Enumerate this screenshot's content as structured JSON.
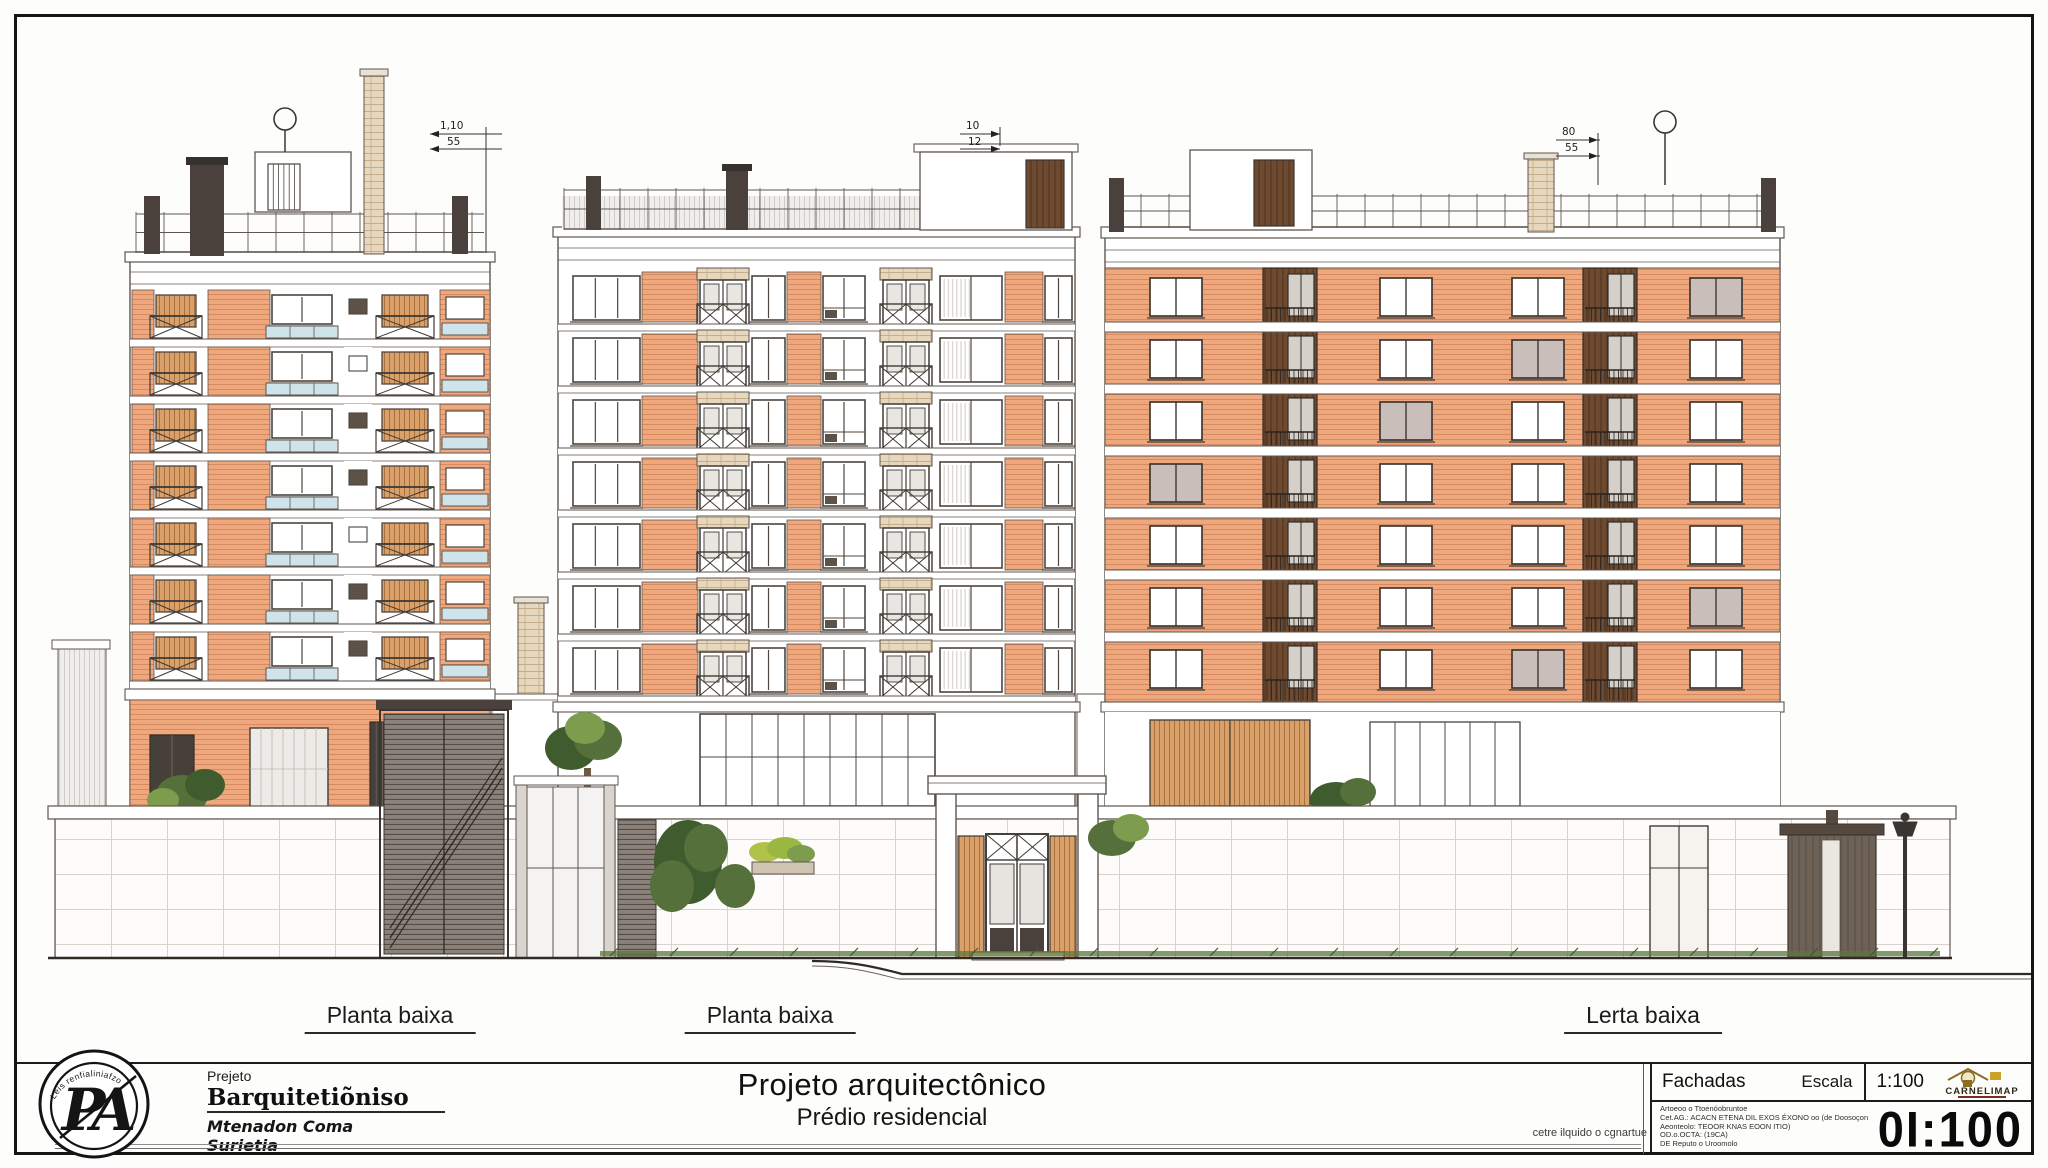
{
  "drawing": {
    "colors": {
      "line": "#5f554e",
      "dark": "#4a413c",
      "siding": "#efa87e",
      "siding_stripe": "#d68a5f",
      "shutter": "#d9a069",
      "shutter_stripe": "#a8713f",
      "wood_dark": "#6e4b30",
      "wood_dark_stripe": "#523621",
      "glass_blue": "#cfe3ea",
      "brick": "#e7d7bd",
      "brick_line": "#c4ad8d",
      "tile_line": "#d9d3cb",
      "green_dark": "#3f5c2e",
      "green_mid": "#55703a",
      "green_light": "#7d9c4e",
      "green_yellow": "#b0c24a"
    },
    "buildings": [
      {
        "name": "left-building",
        "elevation_label": "Planta baixa",
        "floors": 7,
        "dim_top": "1,10",
        "dim_bottom": "55"
      },
      {
        "name": "center-building",
        "elevation_label": "Planta baixa",
        "floors": 7,
        "dim_top": "10",
        "dim_bottom": "12"
      },
      {
        "name": "right-building",
        "elevation_label": "Lerta baixa",
        "floors": 7,
        "dim_top": "80",
        "dim_bottom": "55"
      }
    ]
  },
  "titleblock": {
    "left": {
      "logo_monogram": "PA",
      "logo_arc_text": "Leis renfialiniafzo",
      "project_label": "Prejeto",
      "firm_name": "Barquitetiõniso",
      "author_line1": "Mtenadon Coma",
      "author_line2": "Surietia"
    },
    "center": {
      "title": "Projeto arquitectônico",
      "subtitle": "Prédio residencial",
      "note": "cetre ilquido o cgnartue"
    },
    "right": {
      "section_title": "Fachadas",
      "scale_label": "Escala",
      "scale_value": "1:100",
      "logo_text": "CARNELIMAP",
      "notes": [
        "Artoeoo o Ttoenóobruntoe",
        "Cet.AG.: ACACN ETENA DIL EXOS ÉXONO oo (de Doosoçonóis)",
        "Aeonteolo: TEOOR KNAS EOON ITIO)",
        "OD.o.OCTA: (19CA)",
        "DE Reputo o Uroomolo"
      ],
      "sheet_number": "0I:100"
    }
  }
}
